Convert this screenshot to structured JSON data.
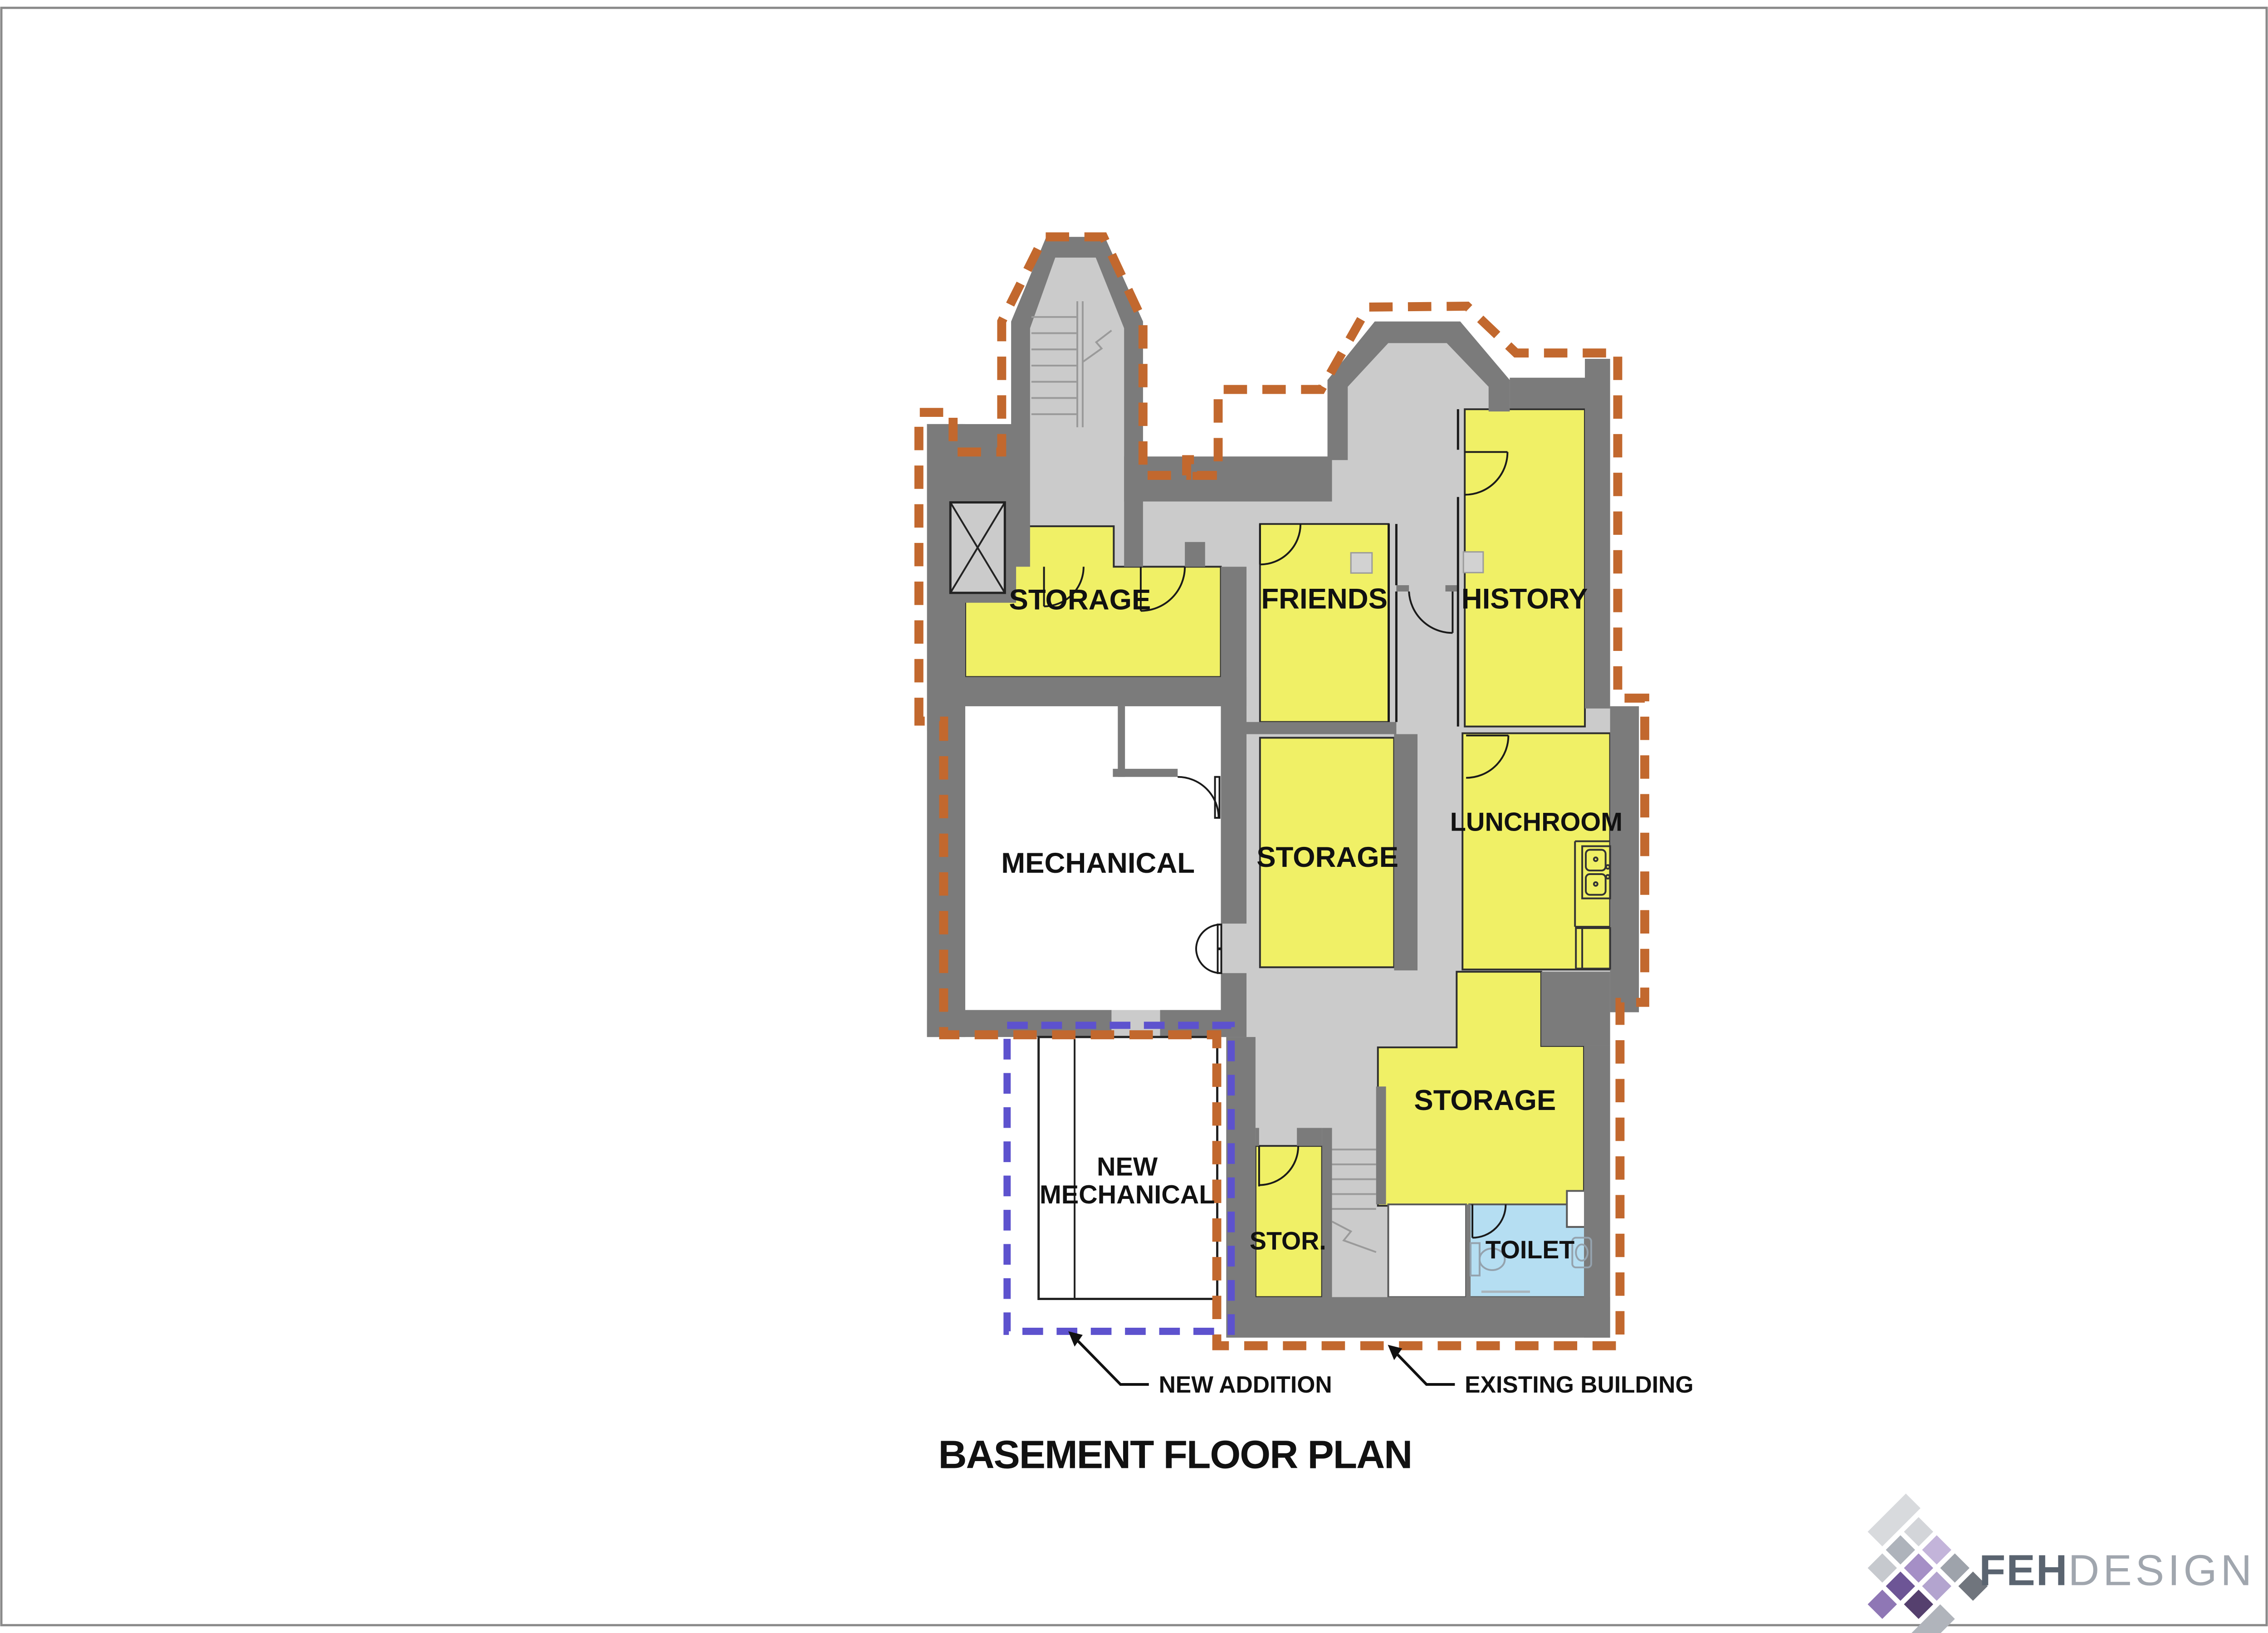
{
  "document": {
    "title": "BASEMENT FLOOR PLAN"
  },
  "rooms": {
    "storage_upper_left": "STORAGE",
    "friends": "FRIENDS",
    "history": "HISTORY",
    "storage_middle": "STORAGE",
    "lunchroom": "LUNCHROOM",
    "mechanical": "MECHANICAL",
    "new_mechanical_line1": "NEW",
    "new_mechanical_line2": "MECHANICAL",
    "storage_lower": "STORAGE",
    "storage_small": "STOR.",
    "toilet": "TOILET"
  },
  "legend": {
    "new_addition": "NEW ADDITION",
    "existing_building": "EXISTING BUILDING"
  },
  "logo": {
    "name": "FEH",
    "suffix": "DESIGN"
  },
  "colors": {
    "room_fill": "#F0F066",
    "toilet_fill": "#B5DEF2",
    "wall": "#7B7B7B",
    "floor": "#CBCBCB",
    "existing_boundary": "#C2682E",
    "new_addition_boundary": "#5D52CE"
  }
}
